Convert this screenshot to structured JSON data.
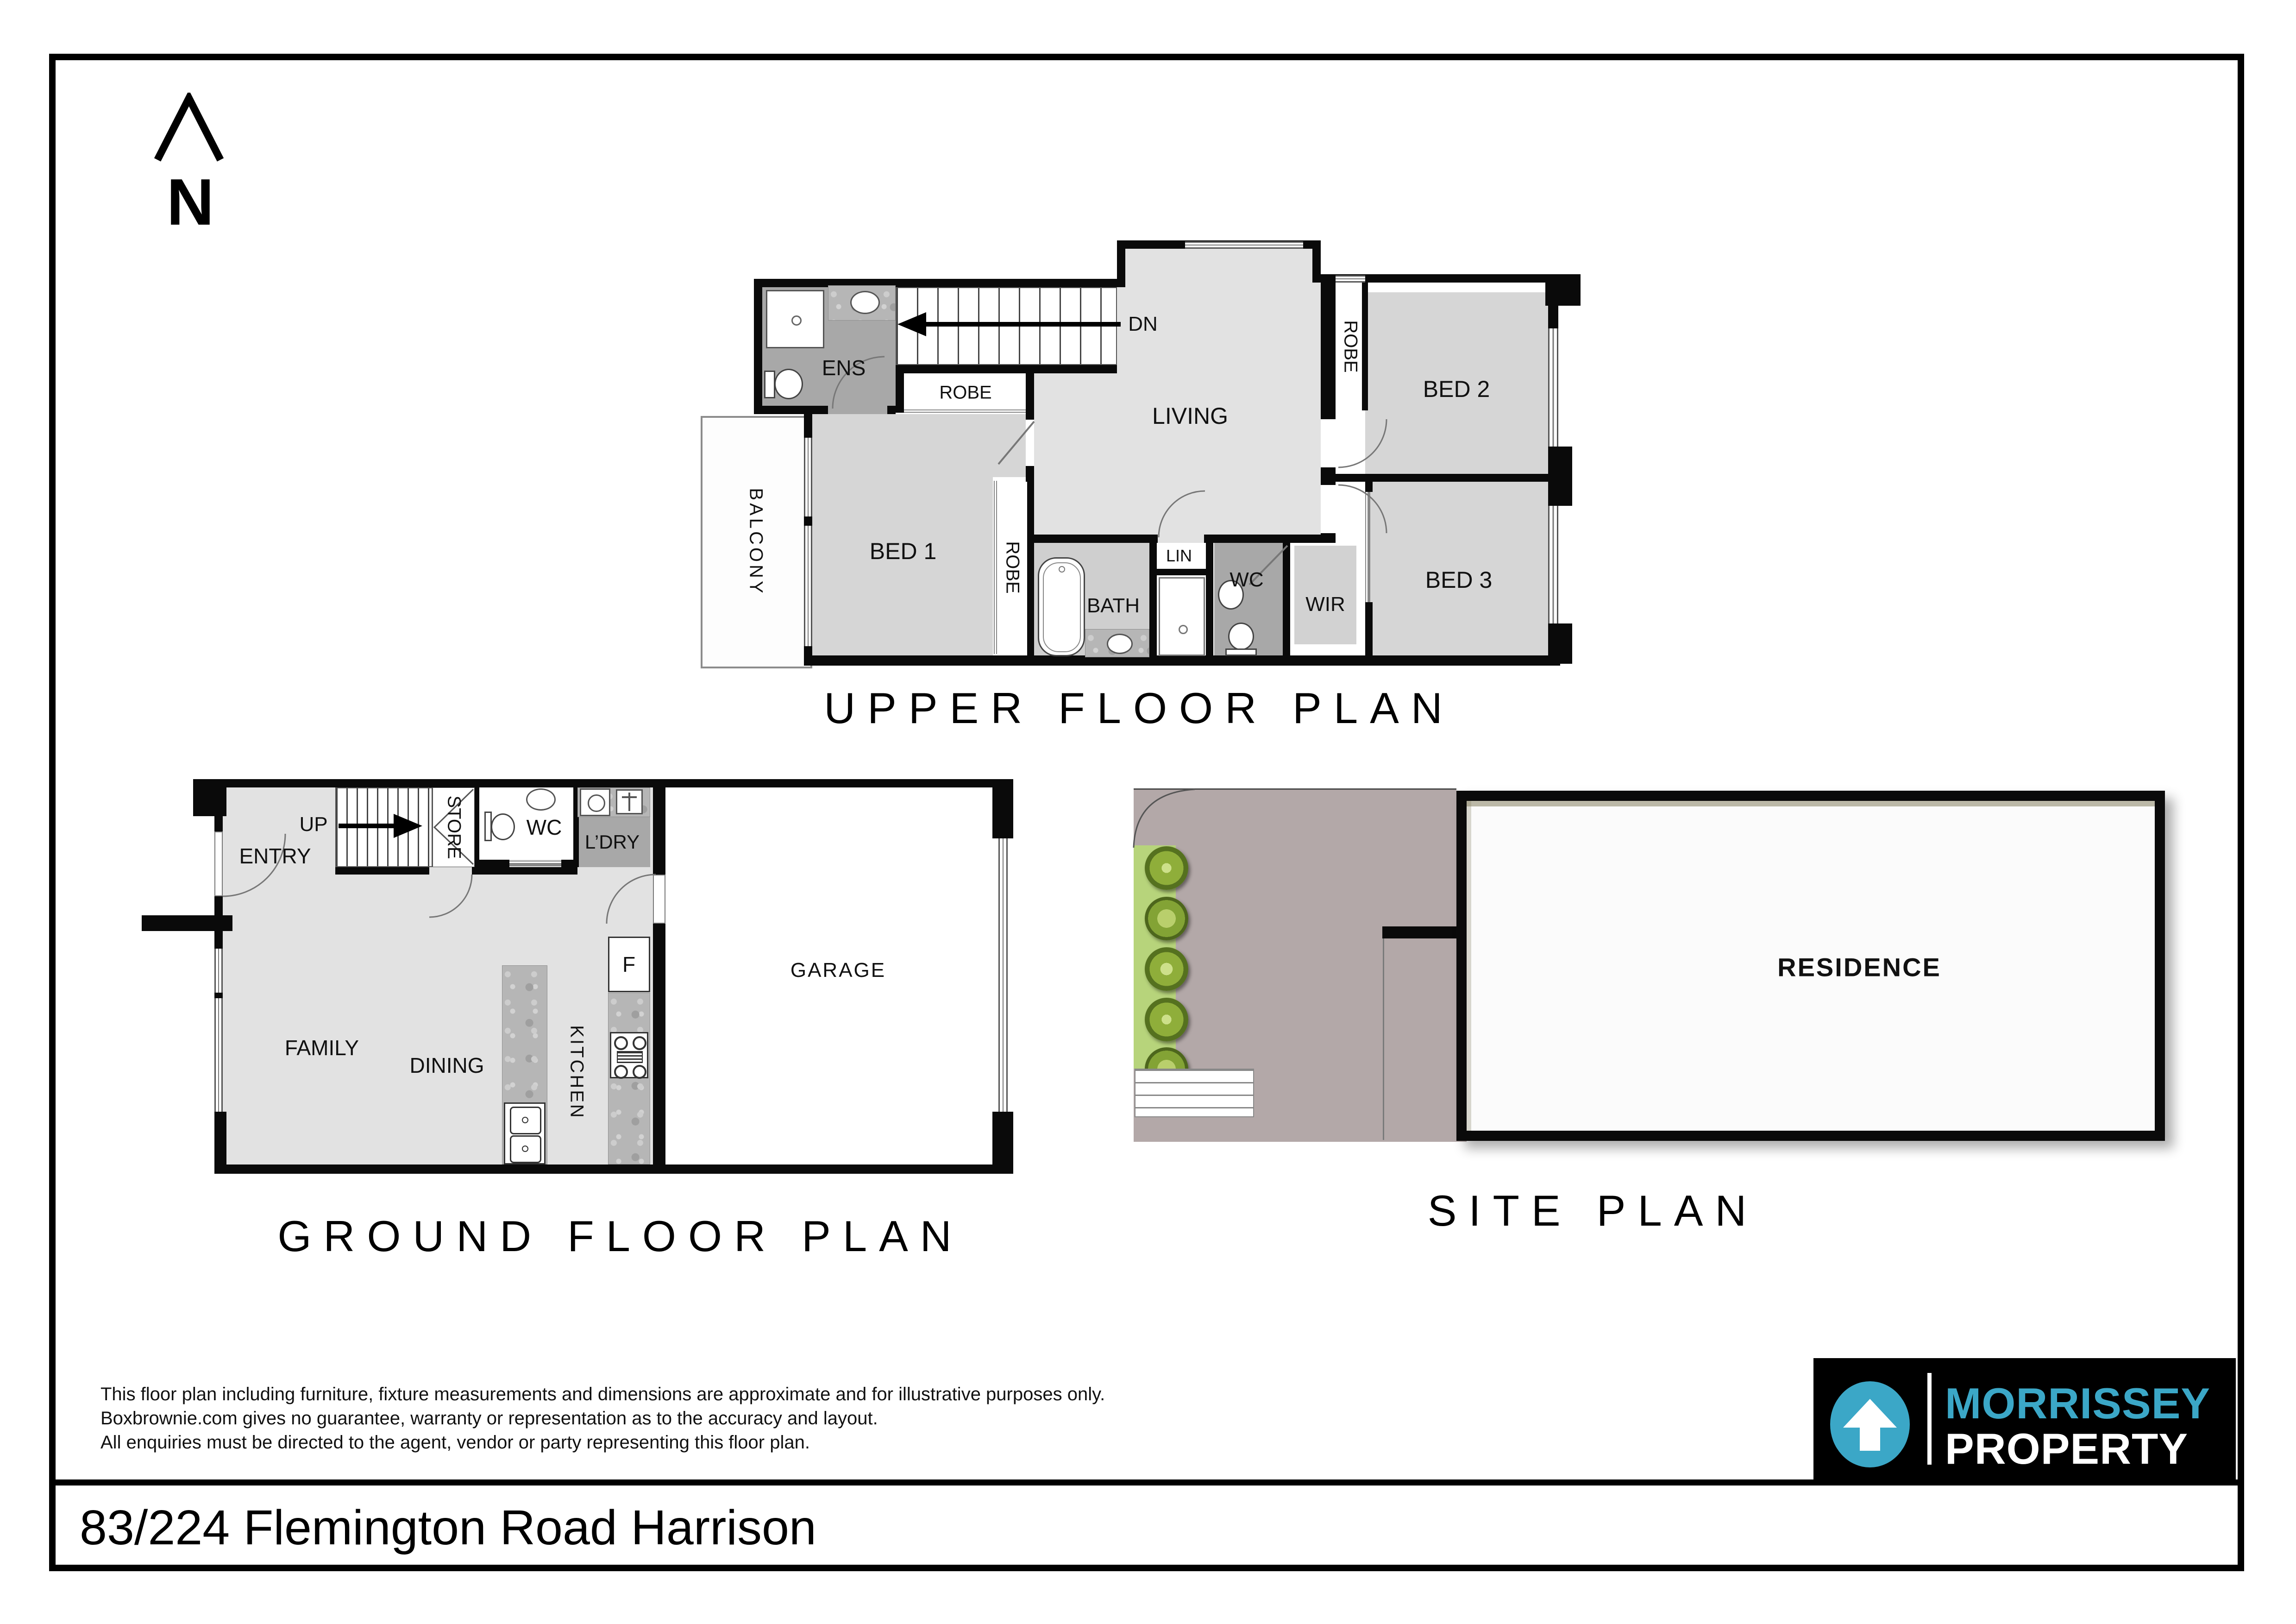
{
  "page": {
    "address": "83/224 Flemington Road Harrison"
  },
  "north": {
    "label": "N"
  },
  "upper_plan": {
    "title": "UPPER FLOOR PLAN",
    "stair_label": "DN",
    "rooms": {
      "ens": "ENS",
      "robe_top": "ROBE",
      "living": "LIVING",
      "robe_bed2": "ROBE",
      "bed2": "BED 2",
      "balcony": "BALCONY",
      "bed1": "BED 1",
      "robe_bed1": "ROBE",
      "bath": "BATH",
      "lin": "LIN",
      "wc": "WC",
      "wir": "WIR",
      "bed3": "BED 3"
    }
  },
  "ground_plan": {
    "title": "GROUND FLOOR PLAN",
    "stair_label": "UP",
    "rooms": {
      "entry": "ENTRY",
      "store": "STORE",
      "wc": "WC",
      "ldry": "L’DRY",
      "family": "FAMILY",
      "dining": "DINING",
      "kitchen": "KITCHEN",
      "garage": "GARAGE",
      "fridge": "F"
    }
  },
  "site_plan": {
    "title": "SITE PLAN",
    "residence_label": "RESIDENCE"
  },
  "disclaimer": {
    "line1": "This floor plan including furniture, fixture measurements and dimensions are approximate and for illustrative purposes only.",
    "line2": "Boxbrownie.com gives no guarantee, warranty or representation as to the accuracy and layout.",
    "line3": "All enquiries must be directed to the agent, vendor or party representing this floor plan.",
    "colors": {
      "text": "#111111"
    }
  },
  "logo": {
    "brand_top": "MORRISSEY",
    "brand_bottom": "PROPERTY",
    "accent_color": "#3BA7C7",
    "bg_color": "#000000"
  },
  "colors": {
    "wall": "#0a0a0a",
    "floor_light": "#e2e2e2",
    "floor_mid": "#d6d6d6",
    "floor_dark": "#a8a8a8",
    "site_mauve": "#b3a8a8",
    "garden_green": "#b7d47b",
    "tree_green": "#8fae3a"
  }
}
